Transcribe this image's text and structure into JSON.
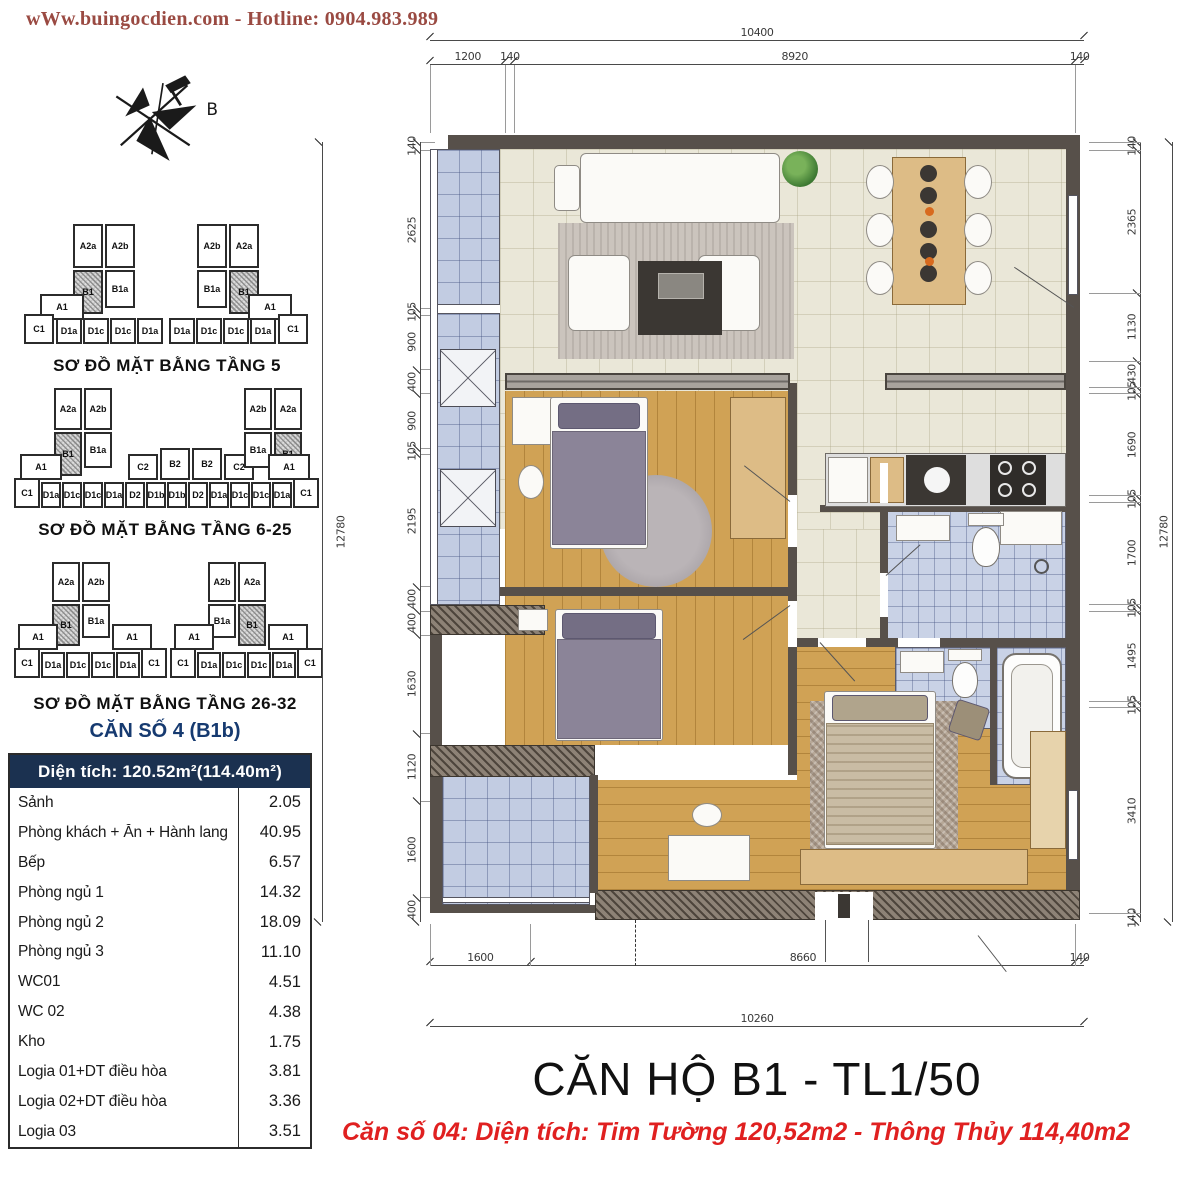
{
  "header": {
    "website_hotline": "wWw.buingocdien.com  -  Hotline: 0904.983.989"
  },
  "compass": {
    "label": "B"
  },
  "mini_plans": [
    {
      "title": "SƠ ĐỒ MẶT BẰNG TẦNG 5",
      "blocks": [
        [
          "A2a",
          57,
          2,
          30,
          44,
          0
        ],
        [
          "A2b",
          89,
          2,
          30,
          44,
          0
        ],
        [
          "B1",
          57,
          48,
          30,
          44,
          1
        ],
        [
          "B1a",
          89,
          48,
          30,
          38,
          0
        ],
        [
          "A1",
          24,
          72,
          44,
          26,
          0
        ],
        [
          "C1",
          8,
          92,
          30,
          30,
          0
        ],
        [
          "D1a",
          40,
          96,
          26,
          26,
          0
        ],
        [
          "D1c",
          67,
          96,
          26,
          26,
          0
        ],
        [
          "D1c",
          94,
          96,
          26,
          26,
          0
        ],
        [
          "D1a",
          121,
          96,
          26,
          26,
          0
        ],
        [
          "A2b",
          181,
          2,
          30,
          44,
          0
        ],
        [
          "A2a",
          213,
          2,
          30,
          44,
          0
        ],
        [
          "B1a",
          181,
          48,
          30,
          38,
          0
        ],
        [
          "B1",
          213,
          48,
          30,
          44,
          1
        ],
        [
          "A1",
          232,
          72,
          44,
          26,
          0
        ],
        [
          "D1a",
          153,
          96,
          26,
          26,
          0
        ],
        [
          "D1c",
          180,
          96,
          26,
          26,
          0
        ],
        [
          "D1c",
          207,
          96,
          26,
          26,
          0
        ],
        [
          "D1a",
          234,
          96,
          26,
          26,
          0
        ],
        [
          "C1",
          262,
          92,
          30,
          30,
          0
        ]
      ]
    },
    {
      "title": "SƠ ĐỒ MẶT BẰNG TẦNG 6-25",
      "blocks": [
        [
          "A2a",
          44,
          2,
          28,
          42,
          0
        ],
        [
          "A2b",
          74,
          2,
          28,
          42,
          0
        ],
        [
          "B1",
          44,
          46,
          28,
          44,
          1
        ],
        [
          "B1a",
          74,
          46,
          28,
          36,
          0
        ],
        [
          "A1",
          10,
          68,
          42,
          26,
          0
        ],
        [
          "C2",
          118,
          68,
          30,
          26,
          0
        ],
        [
          "B2",
          150,
          62,
          30,
          32,
          0
        ],
        [
          "B2",
          182,
          62,
          30,
          32,
          0
        ],
        [
          "C2",
          214,
          68,
          30,
          26,
          0
        ],
        [
          "A2b",
          234,
          2,
          28,
          42,
          0
        ],
        [
          "A2a",
          264,
          2,
          28,
          42,
          0
        ],
        [
          "B1a",
          234,
          46,
          28,
          36,
          0
        ],
        [
          "B1",
          264,
          46,
          28,
          44,
          1
        ],
        [
          "A1",
          258,
          68,
          42,
          26,
          0
        ],
        [
          "C1",
          4,
          92,
          26,
          30,
          0
        ],
        [
          "D1a",
          31,
          96,
          20,
          26,
          0
        ],
        [
          "D1c",
          52,
          96,
          20,
          26,
          0
        ],
        [
          "D1c",
          73,
          96,
          20,
          26,
          0
        ],
        [
          "D1a",
          94,
          96,
          20,
          26,
          0
        ],
        [
          "D2",
          115,
          96,
          20,
          26,
          0
        ],
        [
          "D1b",
          136,
          96,
          20,
          26,
          0
        ],
        [
          "D1b",
          157,
          96,
          20,
          26,
          0
        ],
        [
          "D2",
          178,
          96,
          20,
          26,
          0
        ],
        [
          "D1a",
          199,
          96,
          20,
          26,
          0
        ],
        [
          "D1c",
          220,
          96,
          20,
          26,
          0
        ],
        [
          "D1c",
          241,
          96,
          20,
          26,
          0
        ],
        [
          "D1a",
          262,
          96,
          20,
          26,
          0
        ],
        [
          "C1",
          283,
          92,
          26,
          30,
          0
        ]
      ]
    },
    {
      "title": "SƠ ĐỒ MẶT BẰNG TẦNG 26-32",
      "blocks": [
        [
          "A2a",
          40,
          2,
          28,
          40,
          0
        ],
        [
          "A2b",
          70,
          2,
          28,
          40,
          0
        ],
        [
          "B1",
          40,
          44,
          28,
          42,
          1
        ],
        [
          "B1a",
          70,
          44,
          28,
          34,
          0
        ],
        [
          "A1",
          6,
          64,
          40,
          26,
          0
        ],
        [
          "A1",
          100,
          64,
          40,
          26,
          0
        ],
        [
          "C1",
          2,
          88,
          26,
          30,
          0
        ],
        [
          "D1a",
          29,
          92,
          24,
          26,
          0
        ],
        [
          "D1c",
          54,
          92,
          24,
          26,
          0
        ],
        [
          "D1c",
          79,
          92,
          24,
          26,
          0
        ],
        [
          "D1a",
          104,
          92,
          24,
          26,
          0
        ],
        [
          "C1",
          129,
          88,
          26,
          30,
          0
        ],
        [
          "A2b",
          196,
          2,
          28,
          40,
          0
        ],
        [
          "A2a",
          226,
          2,
          28,
          40,
          0
        ],
        [
          "B1a",
          196,
          44,
          28,
          34,
          0
        ],
        [
          "B1",
          226,
          44,
          28,
          42,
          1
        ],
        [
          "A1",
          162,
          64,
          40,
          26,
          0
        ],
        [
          "A1",
          256,
          64,
          40,
          26,
          0
        ],
        [
          "C1",
          158,
          88,
          26,
          30,
          0
        ],
        [
          "D1a",
          185,
          92,
          24,
          26,
          0
        ],
        [
          "D1c",
          210,
          92,
          24,
          26,
          0
        ],
        [
          "D1c",
          235,
          92,
          24,
          26,
          0
        ],
        [
          "D1a",
          260,
          92,
          24,
          26,
          0
        ],
        [
          "C1",
          285,
          88,
          26,
          30,
          0
        ]
      ]
    }
  ],
  "unit_label": "CĂN SỐ 4 (B1b)",
  "area_table": {
    "header": "Diện tích: 120.52m²(114.40m²)",
    "rows": [
      {
        "name": "Sảnh",
        "value": "2.05"
      },
      {
        "name": "Phòng khách + Ăn + Hành lang",
        "value": "40.95"
      },
      {
        "name": "Bếp",
        "value": "6.57"
      },
      {
        "name": "Phòng ngủ 1",
        "value": "14.32"
      },
      {
        "name": "Phòng ngủ 2",
        "value": "18.09"
      },
      {
        "name": "Phòng ngủ 3",
        "value": "11.10"
      },
      {
        "name": "WC01",
        "value": "4.51"
      },
      {
        "name": "WC 02",
        "value": "4.38"
      },
      {
        "name": "Kho",
        "value": "1.75"
      },
      {
        "name": "Logia 01+DT điều hòa",
        "value": "3.81"
      },
      {
        "name": "Logia 02+DT điều hòa",
        "value": "3.36"
      },
      {
        "name": "Logia 03",
        "value": "3.51"
      }
    ]
  },
  "dimensions": {
    "top_overall": "10400",
    "top_segments": [
      "1200",
      "140",
      "8920",
      "140"
    ],
    "bottom_segments": [
      "1600",
      "8660",
      "140"
    ],
    "bottom_overall": "10260",
    "left_overall": "12780",
    "left_segments": [
      "140",
      "2625",
      "105",
      "900",
      "400",
      "900",
      "105",
      "2195",
      "400",
      "400",
      "1630",
      "1120",
      "1600",
      "400"
    ],
    "right_overall": "12780",
    "right_segments": [
      "140",
      "2365",
      "1130",
      "430",
      "105",
      "1690",
      "105",
      "1700",
      "105",
      "1495",
      "105",
      "3410",
      "140"
    ]
  },
  "footer": {
    "title": "CĂN HỘ B1 - TL1/50",
    "subtitle": "Căn số 04: Diện tích: Tim Tường 120,52m2 - Thông Thủy 114,40m2"
  },
  "colors": {
    "header_text": "#9a4a42",
    "table_header_bg": "#1b3150",
    "unit_label": "#163a70",
    "subtitle_red": "#e02020",
    "title_black": "#111111",
    "dim_text": "#3a3a3a",
    "wall": "#57504a",
    "wood_floor": "#d0a255",
    "bath_tile": "#c9d2e6",
    "logia_tile": "#c2cce2"
  }
}
